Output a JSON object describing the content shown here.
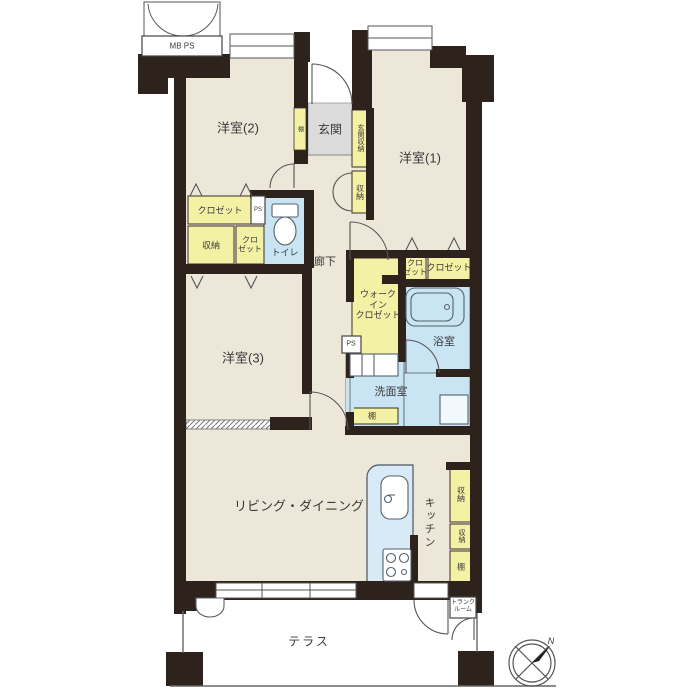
{
  "rooms": {
    "room1": "洋室(1)",
    "room2": "洋室(2)",
    "room3": "洋室(3)",
    "living": "リビング・ダイニング",
    "kitchen": "キッチン",
    "genkan": "玄関",
    "rouka": "廊下",
    "toilet": "トイレ",
    "bath": "浴室",
    "senmen": "洗面室",
    "wic": "ウォーク\nイン\nクロゼット",
    "terrace": "テラス"
  },
  "storage": {
    "genkan_shuno": "玄関収納",
    "shuno_entry": "収納",
    "closet_nw": "クロゼット",
    "shuno_w": "収納",
    "closet_w_small": "クロ\nゼット",
    "closet_e_small": "クロ\nゼット",
    "closet_e": "クロゼット",
    "tana_entry": "棚",
    "tana_senmen": "棚",
    "shuno_k1": "収納",
    "shuno_k2": "収納",
    "tana_k": "棚",
    "trunk": "トランク\nルーム"
  },
  "utility": {
    "mb_ps": "MB  PS",
    "ps1": "PS",
    "ps2": "PS"
  },
  "compass": {
    "north": "N"
  },
  "colors": {
    "wall": "#2d221c",
    "floor": "#ece7d9",
    "storage": "#f3f1a3",
    "wet": "#c9e4f3",
    "counter": "#d7eaf6",
    "entry": "#dbdbdb",
    "line": "#555555"
  }
}
